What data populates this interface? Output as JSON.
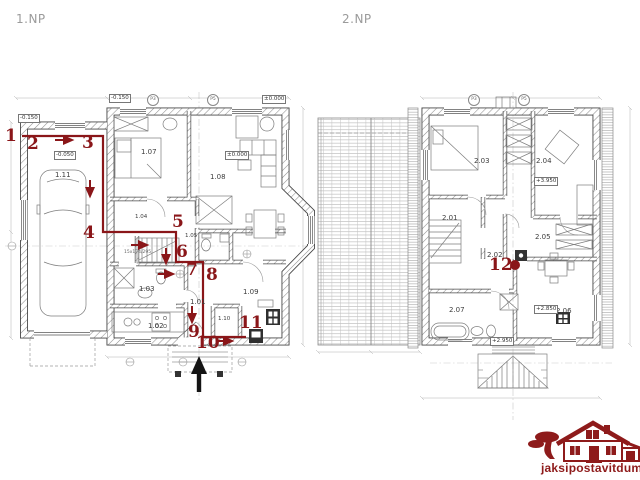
{
  "floor1": {
    "title": "1.NP",
    "rooms": {
      "r101": "1.01",
      "r102": "1.02",
      "r103": "1.03",
      "r104": "1.04",
      "r105": "1.05",
      "r107": "1.07",
      "r108": "1.08",
      "r109": "1.09",
      "r110": "1.10",
      "r111": "1.11"
    },
    "elevations": {
      "top_left": "-0.150",
      "top_right": "±0.000",
      "garage_head": "-0.150",
      "garage": "-0.050",
      "living": "±0.000"
    },
    "stair_spec": "15x174/295",
    "markers": {
      "m1": "P3",
      "m2": "P5"
    }
  },
  "floor2": {
    "title": "2.NP",
    "rooms": {
      "r201": "2.01",
      "r202": "2.02",
      "r203": "2.03",
      "r204": "2.04",
      "r205": "2.05",
      "r206": "2.06",
      "r207": "2.07"
    },
    "elevations": {
      "bedroom": "+3.950",
      "room206": "+2.850",
      "hall": "+2.950"
    },
    "markers": {
      "m1": "P3",
      "m2": "P5"
    }
  },
  "route": {
    "color": "#8a1619",
    "steps": [
      "1",
      "2",
      "3",
      "4",
      "5",
      "6",
      "7",
      "8",
      "9",
      "10",
      "11",
      "12"
    ]
  },
  "logo": {
    "text": "jaksipostavitdum.cz",
    "color": "#8e1b1b"
  }
}
